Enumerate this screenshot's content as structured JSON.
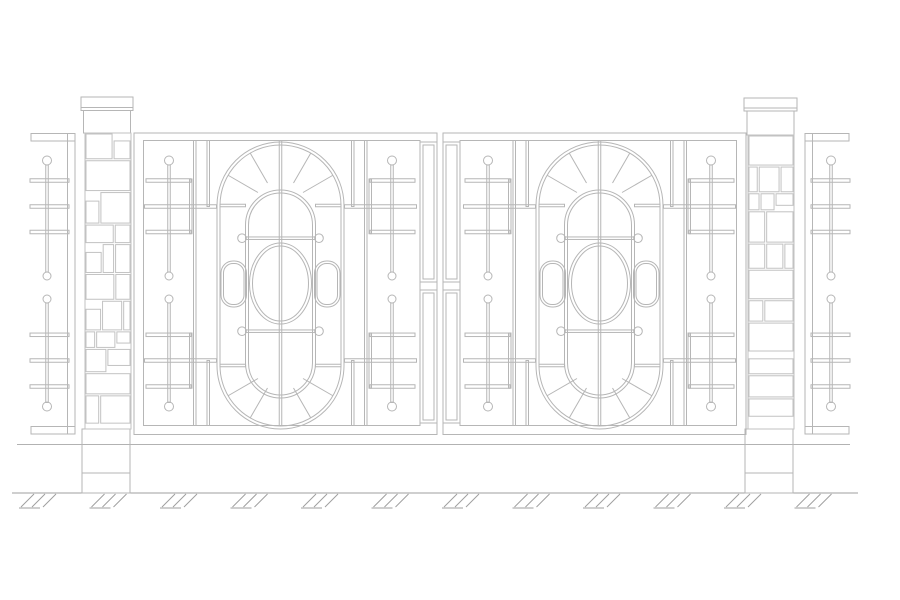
{
  "meta": {
    "title": "Ornamental gate elevation drawing",
    "text_content": "none"
  },
  "canvas": {
    "width": 900,
    "height": 600
  },
  "palette": {
    "background": "#ffffff",
    "line": "#b6b6b6",
    "stone": "#c2c2c2",
    "ground_line": "#9f9f9f",
    "upper_rail": "#b2b2b2",
    "gap_fill": "#e9e9e9",
    "white": "#ffffff"
  },
  "ground": {
    "upper_rail": {
      "y": 444.5,
      "x1": 17,
      "x2": 850
    },
    "line": {
      "y": 493,
      "x1": 12,
      "x2": 858
    },
    "hatch": {
      "centers": [
        43,
        113.5,
        184,
        254.5,
        325,
        395.5,
        466,
        536.5,
        607,
        677.5,
        748,
        818.5
      ],
      "top_y": 494,
      "slash_dx": -13,
      "slash_dy": 13,
      "slash_offsets": [
        -9,
        2,
        13
      ],
      "underline": {
        "x1": -24,
        "x2": -3,
        "y": 508
      }
    }
  },
  "fences": {
    "rail_top_y": 133.5,
    "rail_h": 7.5,
    "rail_bottom_y": 426.5,
    "edge_y": 133.5,
    "edge_h": 300.5,
    "left": {
      "rail_x": 31,
      "rail_w": 44,
      "edge_x": 67.5,
      "edge_w": 7.5,
      "stem_x": 47,
      "bar_x1": 30,
      "bar_x2": 69
    },
    "right": {
      "rail_x": 805,
      "rail_w": 44,
      "edge_x": 805,
      "edge_w": 7.5,
      "stem_x": 831,
      "bar_x1": 811,
      "bar_x2": 850
    }
  },
  "lattice_motif": {
    "circle_r": 4.5,
    "small_circle_r": 4,
    "end_circles_y": [
      160.5,
      406.5
    ],
    "mid_circles_y": [
      276,
      299
    ],
    "stem_segments": [
      [
        165,
        272
      ],
      [
        303,
        402.5
      ]
    ],
    "bars": [
      {
        "y": 180.5,
        "size": "short"
      },
      {
        "y": 206.5,
        "size": "long"
      },
      {
        "y": 232,
        "size": "short"
      },
      {
        "y": 334.8,
        "size": "short"
      },
      {
        "y": 360.5,
        "size": "long"
      },
      {
        "y": 386.5,
        "size": "short"
      }
    ],
    "bar_h": 3.5,
    "stem_w": 2.5
  },
  "pillars": {
    "left": {
      "slab": [
        81,
        97,
        52,
        13.5
      ],
      "slab_line_y": 107.5,
      "band": [
        83.5,
        110.5,
        47,
        22.5
      ],
      "shaft": [
        85,
        133,
        46,
        296
      ],
      "base": [
        82,
        429,
        48,
        64
      ],
      "base_line_y": 473,
      "seed": 11
    },
    "right": {
      "slab": [
        744,
        98,
        53,
        13
      ],
      "slab_line_y": 108,
      "band": [
        747,
        111,
        47,
        24
      ],
      "shaft": [
        748,
        135,
        46,
        294
      ],
      "base": [
        745,
        429,
        48,
        64
      ],
      "base_line_y": 473,
      "seed": 29
    }
  },
  "gate": {
    "mirror_width": 880,
    "gap_band": [
      418,
      282,
      44,
      8
    ],
    "leaf": {
      "axis": 280.5,
      "dl": 2.5,
      "frame_outer": [
        134,
        133,
        303,
        301.5
      ],
      "frame_inner": [
        143.5,
        140.5,
        276.5,
        285
      ],
      "stile": {
        "x": 420,
        "w": 17,
        "inset": 3,
        "top": [
          142,
          282
        ],
        "bottom": [
          290,
          423
        ]
      },
      "divider_x": [
        194.75,
        365.75
      ],
      "divider_y": [
        140.5,
        425.5
      ],
      "strip": {
        "stems": [
          169,
          392
        ],
        "short_bar": [
          146,
          191
        ],
        "long_bar": [
          144.5,
          216.5
        ],
        "grid_x": 190.75,
        "grid_segs": [
          [
            179,
            233.7
          ],
          [
            333,
            388.2
          ]
        ],
        "aux_x": 208.25,
        "aux_segs": [
          [
            140.5,
            206.5
          ],
          [
            360.5,
            425.5
          ]
        ]
      },
      "outer_stadium": [
        217,
        142,
        127,
        287
      ],
      "inner_stadium": [
        245.5,
        190,
        70,
        208
      ],
      "stadium_inset": 3,
      "spokes": {
        "top_c": [
          280.5,
          205.5
        ],
        "bottom_c": [
          280.5,
          365.5
        ],
        "angles_deg": [
          30,
          60
        ],
        "r1": 26,
        "r2": 60.5,
        "h_inner": [
          220,
          245.5
        ],
        "h_outer": [
          315.5,
          341
        ]
      },
      "center_line_x": 280.5,
      "center_line_y": [
        140.5,
        425.5
      ],
      "bolt_rows": {
        "ys": [
          238.2,
          331.2
        ],
        "x1": 246,
        "x2": 315,
        "circle_x": [
          242,
          319
        ],
        "r": 4.3
      },
      "ellipse": {
        "cx": 280.5,
        "cy": 283.5,
        "rx": 31,
        "ry": 40.5,
        "inset": 3
      },
      "pills": {
        "rects": [
          [
            221,
            261,
            25.5,
            46
          ],
          [
            314.5,
            261,
            25.5,
            46
          ]
        ],
        "r": 12,
        "inset": 2.5
      }
    }
  }
}
